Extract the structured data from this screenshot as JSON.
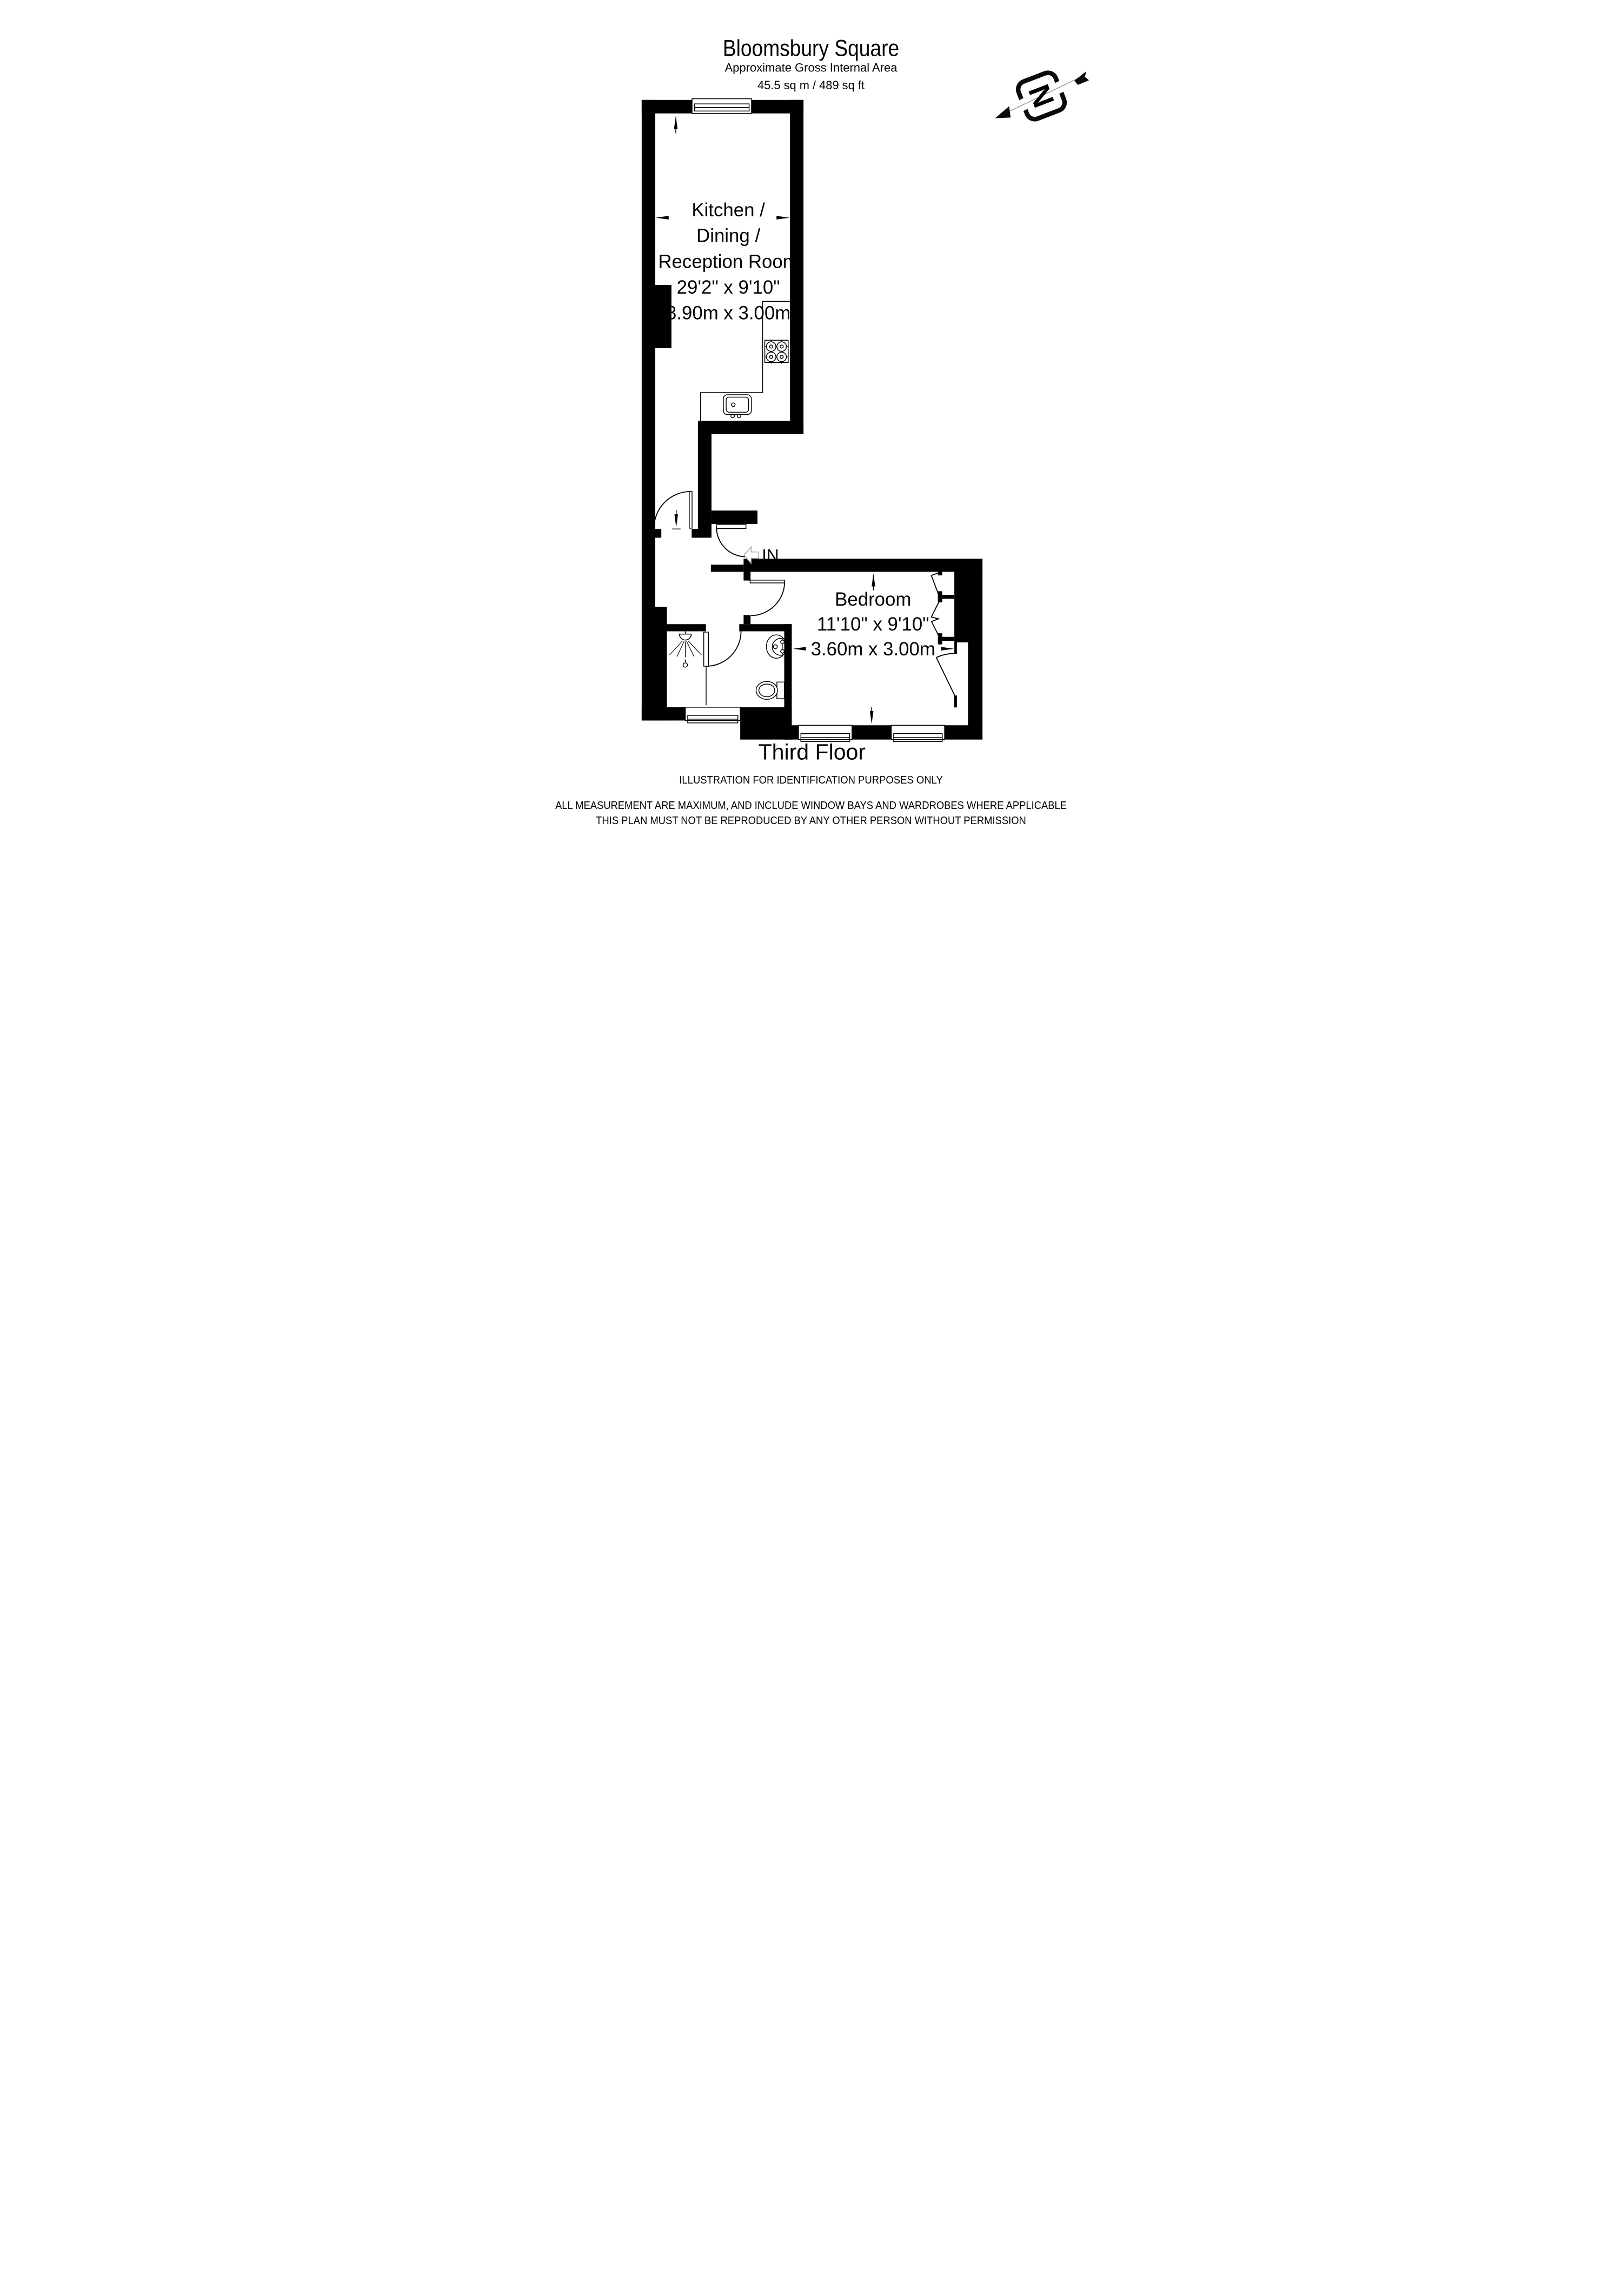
{
  "header": {
    "title": "Bloomsbury Square",
    "subtitle": "Approximate Gross Internal Area",
    "area": "45.5 sq m / 489 sq ft"
  },
  "compass": {
    "label": "N"
  },
  "rooms": {
    "kitchen": {
      "lines": [
        "Kitchen /",
        "Dining /",
        "Reception Room",
        "29'2\" x 9'10\"",
        "8.90m x 3.00m"
      ]
    },
    "bedroom": {
      "lines": [
        "Bedroom",
        "11'10\" x 9'10\"",
        "3.60m x 3.00m"
      ]
    }
  },
  "entry": {
    "label": "IN"
  },
  "footer": {
    "floor_label": "Third Floor",
    "disclaimer1": "ILLUSTRATION FOR IDENTIFICATION PURPOSES ONLY",
    "disclaimer2": "ALL MEASUREMENT  ARE MAXIMUM, AND INCLUDE WINDOW BAYS AND WARDROBES WHERE APPLICABLE",
    "disclaimer3": "THIS PLAN MUST NOT BE REPRODUCED BY ANY OTHER PERSON WITHOUT PERMISSION"
  },
  "icons": [
    "compass-icon",
    "hob-icon",
    "kitchen-sink-icon",
    "shower-icon",
    "basin-icon",
    "toilet-icon",
    "entry-arrow-icon"
  ],
  "colors": {
    "wall": "#000000",
    "background": "#ffffff",
    "entry_arrow_outline": "#a8a8a8",
    "compass_line": "#9a9a9a"
  }
}
